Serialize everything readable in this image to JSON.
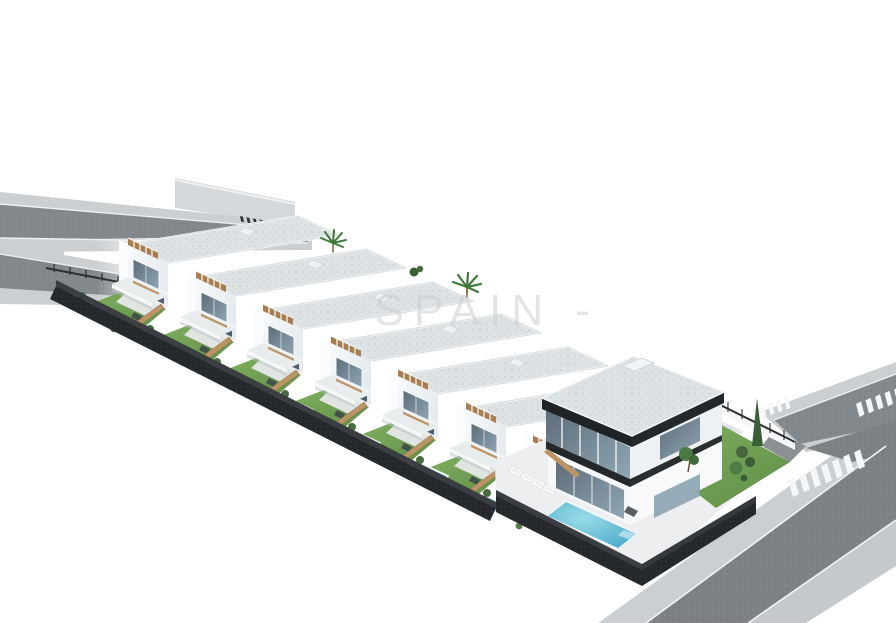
{
  "scene": {
    "alt": "Aerial 3D architectural rendering of a new-build development: a diagonal row of seven white two-storey townhouses, each with a roof pergola, private garden and small pool, plus one larger detached modern villa with a big pool, surrounded by a dark perimeter wall and grey asphalt streets with zebra crossings on a white background",
    "watermark": "SPAIN -",
    "development": {
      "townhouse_count": 7,
      "villa_count": 1,
      "pool_count": 8,
      "features": [
        "roof terraces with wooden pergolas",
        "private gardens with lawns and shrubs",
        "small private plunge pools",
        "dark stone perimeter wall",
        "asphalt roads with white zebra crossings",
        "palm trees on roof terraces",
        "sun loungers on villa terrace",
        "villa with dark roof fascia and glass facade"
      ]
    },
    "colors": {
      "background": "#ffffff",
      "building_white": "#f4f6f8",
      "building_shadow": "#e4e9ed",
      "glass": "#51616d",
      "glass_light": "#8ca3b1",
      "roof": "#dde2e5",
      "roof_speckle": "#c2c9ce",
      "dark_trim": "#212529",
      "pergola_wood": "#a87e50",
      "fence_wood": "#bb9464",
      "lawn": "#6f9e52",
      "shrub": "#476b3f",
      "pool_water": "#49b0cc",
      "pool_light": "#8fd3e2",
      "perimeter_wall": "#26292c",
      "asphalt": "#82878b",
      "sidewalk": "#cbcfd1",
      "road_marking": "#f4f6f7",
      "watermark": "#c9cccd"
    }
  }
}
